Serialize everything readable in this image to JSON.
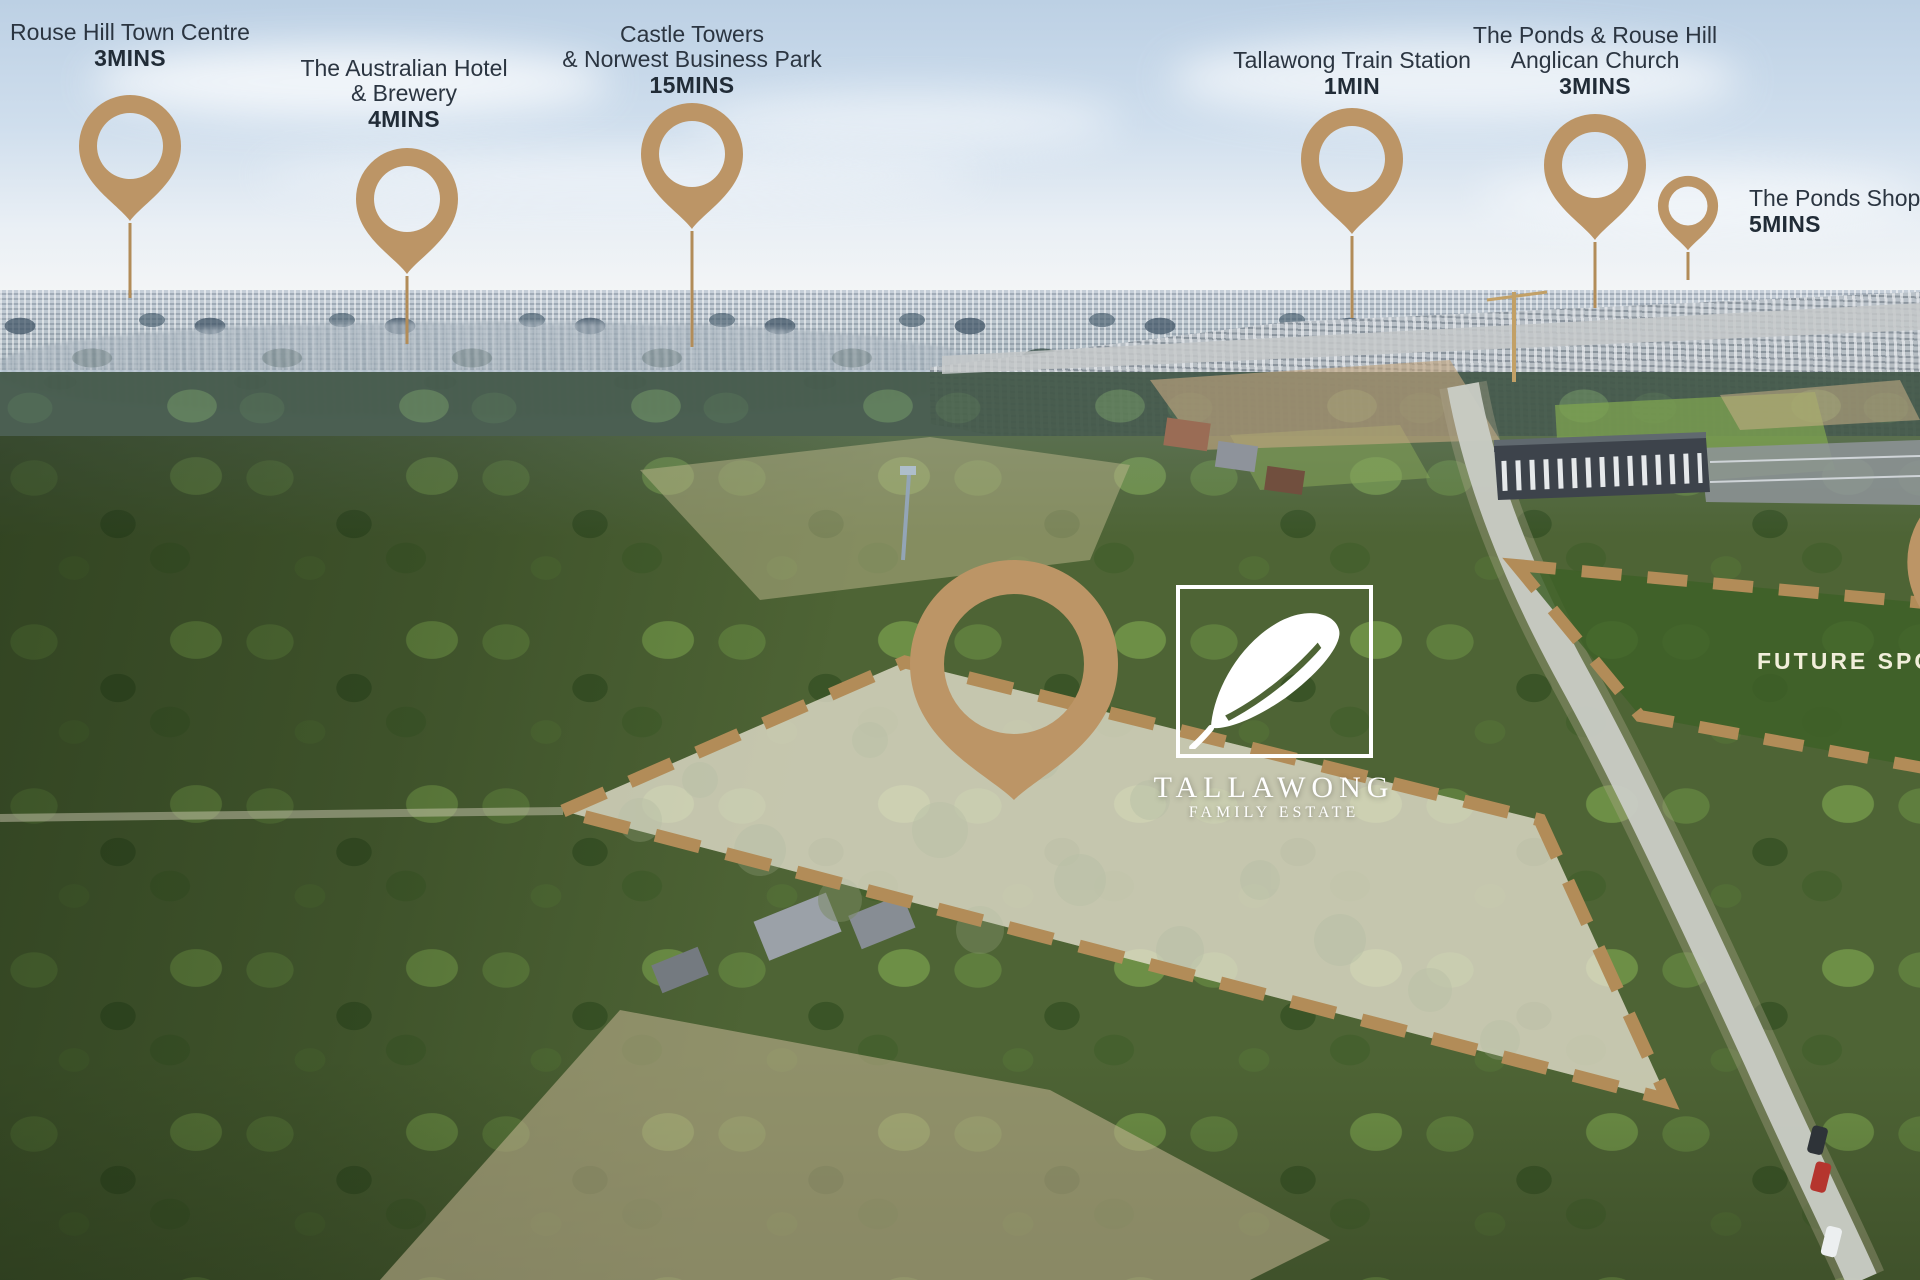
{
  "palette": {
    "pin_gold": "#BC9566",
    "dash_gold": "#B28C58",
    "label_text": "#2B3541",
    "future_area_green": "#3E6127",
    "future_label_cream": "#F1EEDA",
    "logo_white": "#FFFFFF"
  },
  "markers": [
    {
      "name": "rouse-hill-town-centre",
      "line1": "Rouse Hill Town Centre",
      "time": "3MINS"
    },
    {
      "name": "australian-hotel-brewery",
      "line1": "The Australian Hotel",
      "line2": "& Brewery",
      "time": "4MINS"
    },
    {
      "name": "castle-towers-norwest",
      "line1": "Castle Towers",
      "line2": "& Norwest Business Park",
      "time": "15MINS"
    },
    {
      "name": "tallawong-train-station",
      "line1": "Tallawong Train Station",
      "time": "1MIN"
    },
    {
      "name": "ponds-rouse-hill-anglican",
      "line1": "The Ponds & Rouse Hill",
      "line2": "Anglican Church",
      "time": "3MINS"
    },
    {
      "name": "ponds-shopping",
      "line1": "The Ponds Shopping",
      "time": "5MINS"
    }
  ],
  "estate": {
    "name": "TALLAWONG",
    "subtitle": "FAMILY ESTATE"
  },
  "future_area": {
    "label": "FUTURE SPORTS"
  }
}
